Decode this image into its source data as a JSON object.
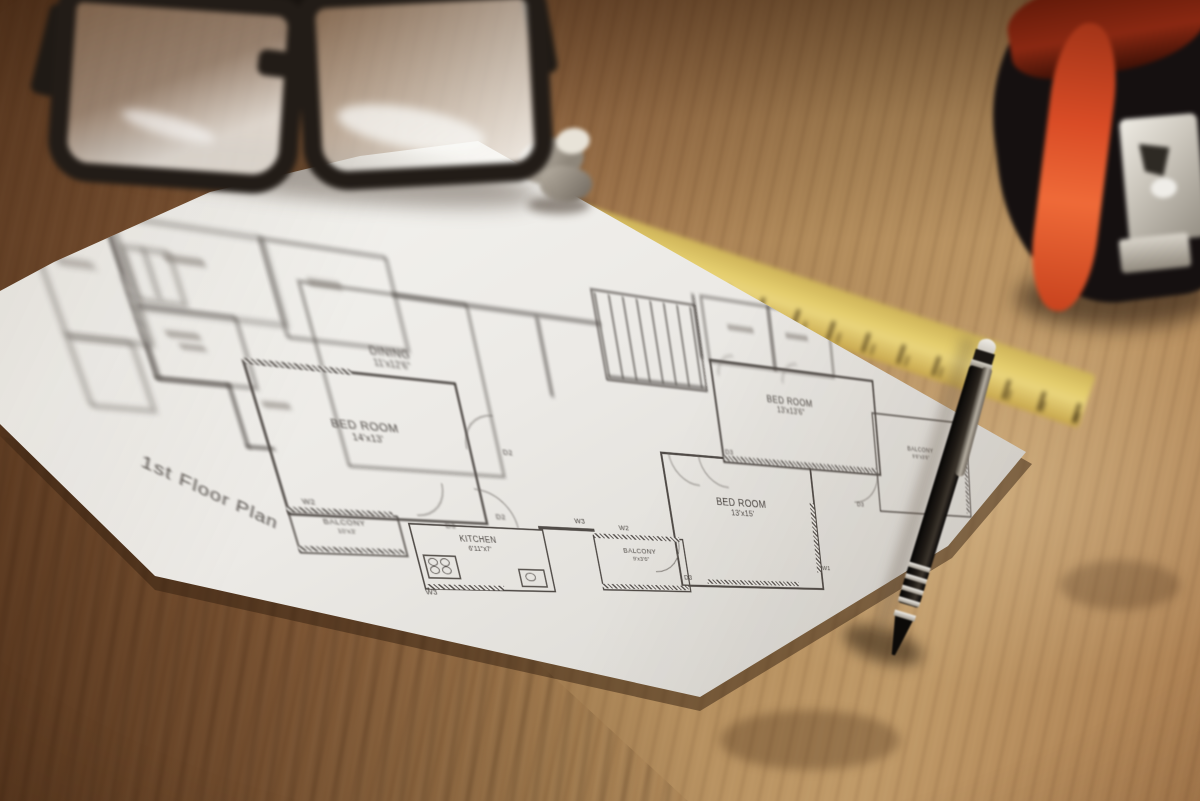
{
  "scene": {
    "description": "Photograph of a printed 1st-floor architectural plan lying on a wooden desk, with black-rimmed eyeglasses, a yellow folding ruler, a black-and-orange tape measure and a black ballpoint pen",
    "objects": [
      "eyeglasses",
      "floor-plan-sheet",
      "folding-ruler",
      "tape-measure",
      "ballpoint-pen",
      "wooden-desk"
    ]
  },
  "plan": {
    "title": "1st Floor Plan",
    "rooms": {
      "bedroom1": {
        "name": "BED ROOM",
        "dims": "14'x13'"
      },
      "balcony1": {
        "name": "BALCONY",
        "dims": "10'x3'"
      },
      "kitchen": {
        "name": "KITCHEN",
        "dims": "6'11\"x7'"
      },
      "dining": {
        "name": "DINING",
        "dims": "11'x12'6\""
      },
      "bedroom2": {
        "name": "BED ROOM",
        "dims": "13'x15'"
      },
      "balcony2": {
        "name": "BALCONY",
        "dims": "9'x3'6\""
      },
      "bedroom3": {
        "name": "BED ROOM",
        "dims": "13'x13'6\""
      },
      "balcony3": {
        "name": "BALCONY",
        "dims": "9'6\"x3'6\""
      }
    },
    "wall_labels": {
      "w1": "W1",
      "w2": "W2",
      "w3": "W3",
      "d2": "D2",
      "d3": "D3"
    }
  },
  "colors": {
    "paper": "#efede9",
    "ink": "#504b47",
    "wood_light": "#c09a68",
    "wood_dark": "#6e4426",
    "ruler_yellow": "#e4cd6d",
    "tape_accent": "#e0512a",
    "pen_black": "#17130f"
  }
}
